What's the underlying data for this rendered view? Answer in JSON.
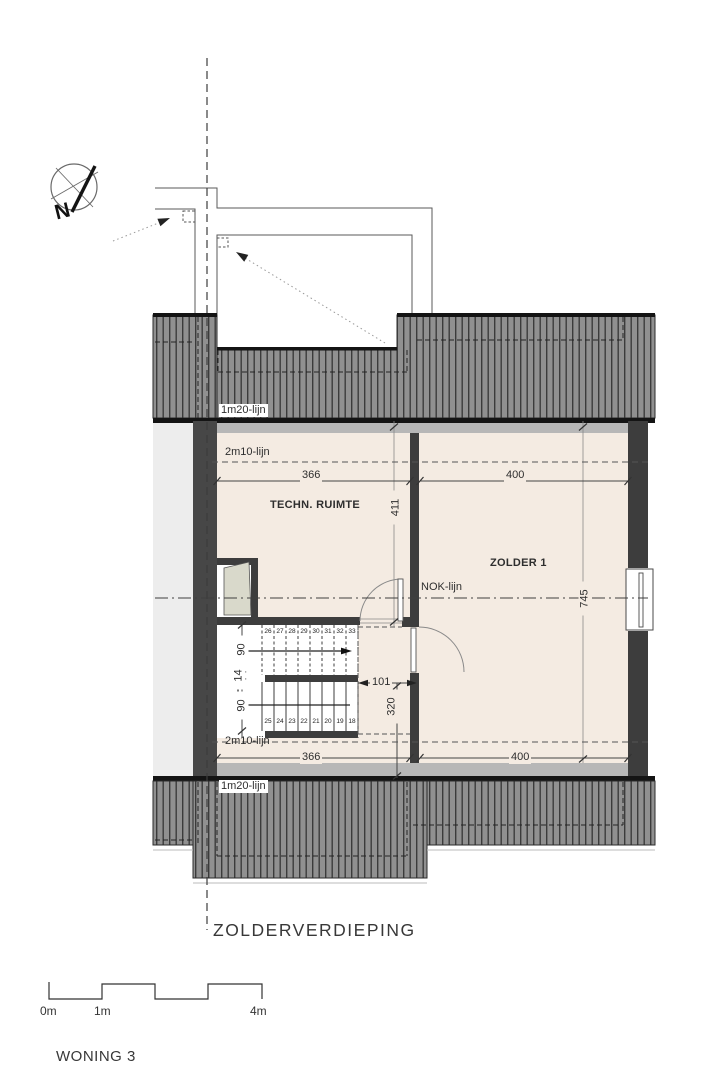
{
  "title": "ZOLDERVERDIEPING",
  "project": "WONING 3",
  "compass": {
    "north": "N"
  },
  "rooms": {
    "techn": "TECHN. RUIMTE",
    "zolder": "ZOLDER 1"
  },
  "ref_lines": {
    "l120_top": "1m20-lijn",
    "l210_top": "2m10-lijn",
    "nok": "NOK-lijn",
    "l210_bottom": "2m10-lijn",
    "l120_bottom": "1m20-lijn"
  },
  "dims": {
    "top_left": "366",
    "top_right": "400",
    "techn_depth": "411",
    "zolder_depth": "745",
    "stair_flight_top": "90",
    "stair_gap": "14",
    "stair_flight_bottom": "90",
    "door": "101",
    "stair_run": "320",
    "bottom_left": "366",
    "bottom_right": "400"
  },
  "stairs": {
    "upper": [
      "26",
      "27",
      "28",
      "29",
      "30",
      "31",
      "32",
      "33"
    ],
    "lower": [
      "25",
      "24",
      "23",
      "22",
      "21",
      "20",
      "19",
      "18"
    ]
  },
  "scale_bar": {
    "m0": "0m",
    "m1": "1m",
    "m4": "4m"
  },
  "colors": {
    "floor": "#f4ebe2",
    "wall": "#3d3d3d",
    "roof_fill": "#909090",
    "roof_stripe": "#3b3b3b",
    "shaft": "#d9d9cb",
    "neighbor_strip": "#ededed",
    "gray_band": "#b7b7b7"
  }
}
